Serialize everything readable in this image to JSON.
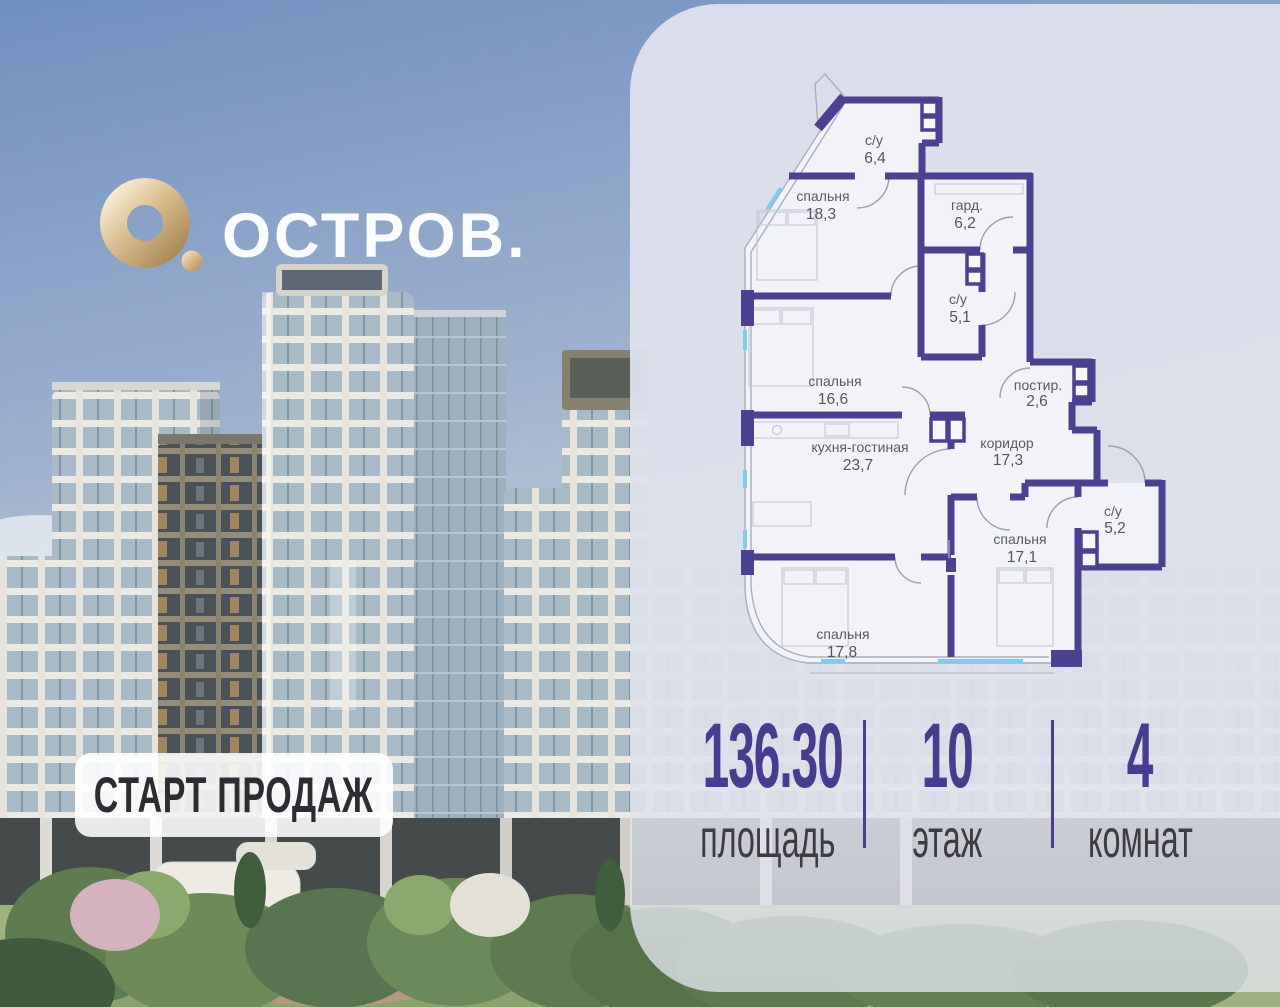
{
  "brand": {
    "name": "ОСТРОВ."
  },
  "badge": {
    "label": "СТАРТ ПРОДАЖ"
  },
  "floor_plan": {
    "rooms": [
      {
        "label": "с/у",
        "area": "6,4"
      },
      {
        "label": "спальня",
        "area": "18,3"
      },
      {
        "label": "гард.",
        "area": "6,2"
      },
      {
        "label": "с/у",
        "area": "5,1"
      },
      {
        "label": "спальня",
        "area": "16,6"
      },
      {
        "label": "постир.",
        "area": "2,6"
      },
      {
        "label": "кухня-гостиная",
        "area": "23,7"
      },
      {
        "label": "коридор",
        "area": "17,3"
      },
      {
        "label": "с/у",
        "area": "5,2"
      },
      {
        "label": "спальня",
        "area": "17,1"
      },
      {
        "label": "спальня",
        "area": "17,8"
      }
    ],
    "colors": {
      "walls": "#4b4190",
      "windows": "#7ccdec"
    }
  },
  "stats": {
    "accent": "#483c90",
    "items": [
      {
        "value": "136.30",
        "label": "площадь"
      },
      {
        "value": "10",
        "label": "этаж"
      },
      {
        "value": "4",
        "label": "комнат"
      }
    ]
  }
}
